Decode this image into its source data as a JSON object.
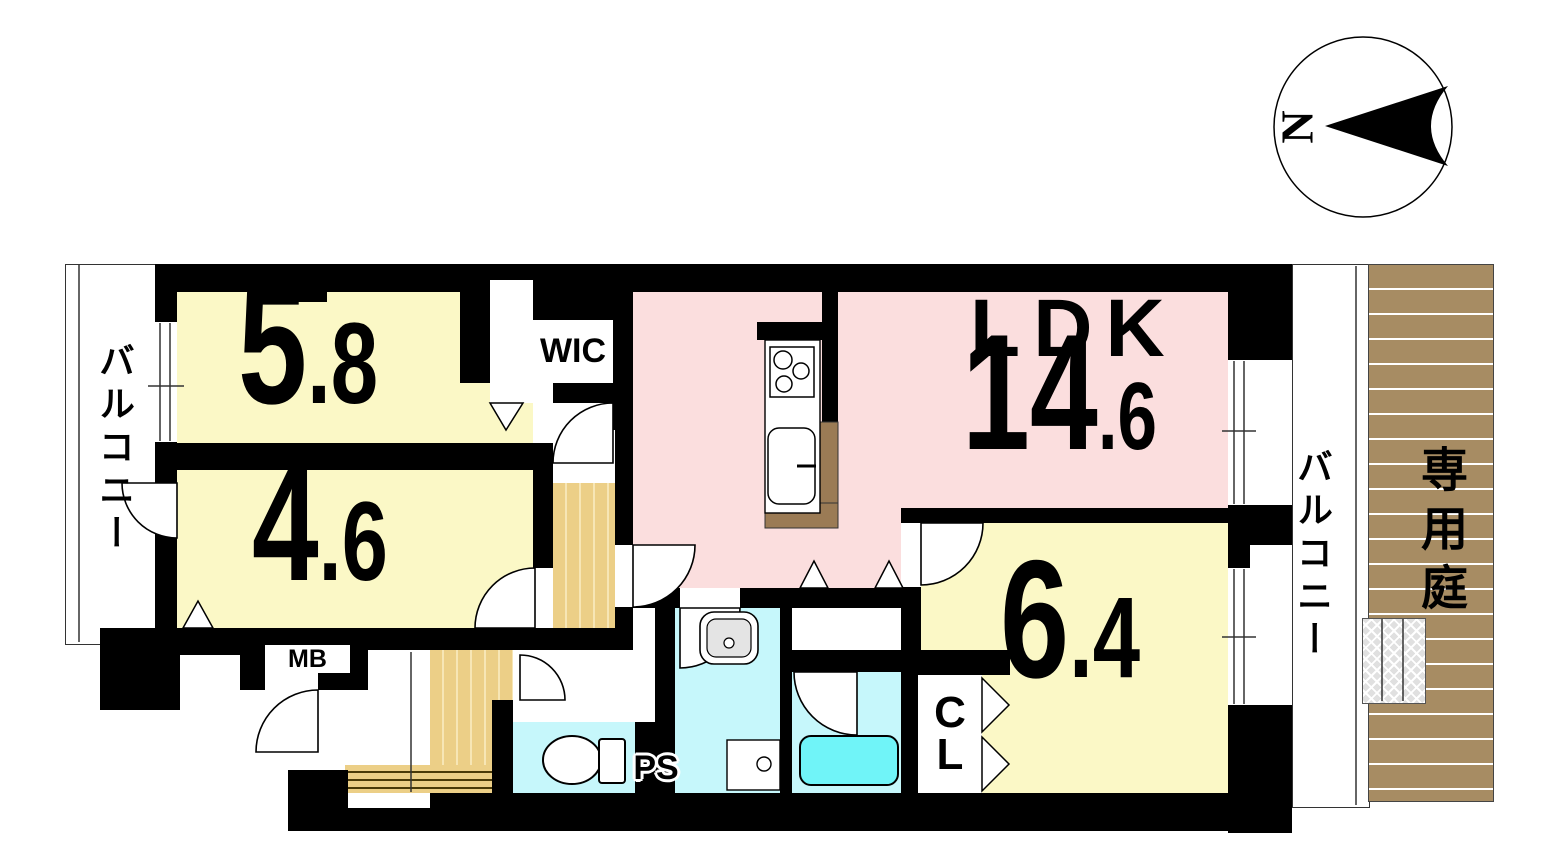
{
  "compass": {
    "north": "N"
  },
  "balcony_left": {
    "label": "バルコニー"
  },
  "balcony_right": {
    "label": "バルコニー"
  },
  "garden": {
    "label": "専用庭"
  },
  "rooms": {
    "bedroom_58": {
      "num": "5",
      "frac": ".8"
    },
    "bedroom_46": {
      "num": "4",
      "frac": ".6"
    },
    "bedroom_64": {
      "num": "6",
      "frac": ".4"
    },
    "ldk": {
      "label": "LDK",
      "num": "14",
      "frac": ".6"
    },
    "wic": {
      "label": "WIC"
    },
    "cl": {
      "line1": "C",
      "line2": "L"
    }
  },
  "utility": {
    "mb": "MB",
    "ps": "PS"
  },
  "colors": {
    "room_yellow": "#fbf8c6",
    "ldk_pink": "#fbdede",
    "wet_area_cyan": "#c6f7fb",
    "bathtub_cyan": "#70f4f8",
    "wood_floor": "#eccf87",
    "deck_brown": "#a78c63",
    "wall_black": "#000000"
  }
}
